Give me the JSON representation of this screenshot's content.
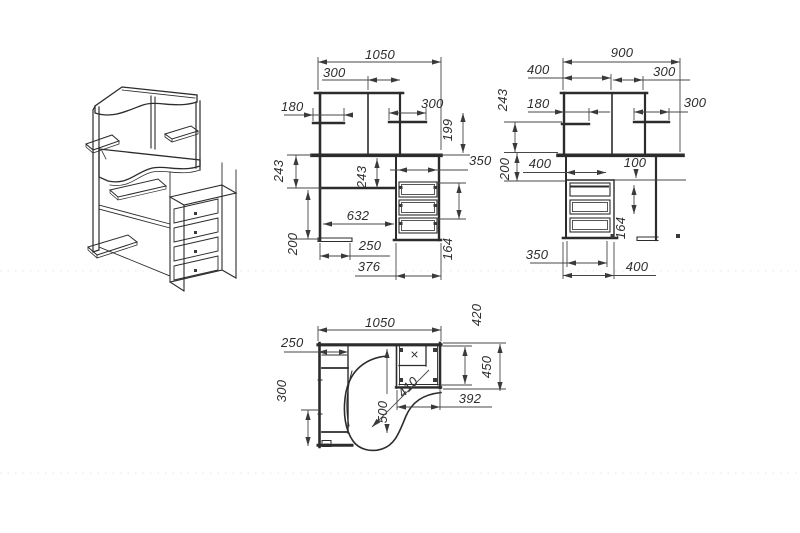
{
  "drawing": {
    "kind": "corner-computer-desk-blueprint",
    "front": {
      "overall_width": "1050",
      "hutch_bay_width": "300",
      "left_shelf_width": "180",
      "right_shelf_width": "300",
      "shelf_to_desktop": "199",
      "pedestal_inner_width": "350",
      "desktop_to_shelf_left": "243",
      "desktop_to_shelf_mid": "243",
      "kneehole_width": "632",
      "shelf_to_floor": "200",
      "foot_width": "250",
      "pedestal_outer_width": "376",
      "drawer_pitch": "164"
    },
    "side": {
      "overall_depth": "900",
      "hutch_left_bay": "400",
      "hutch_right_bay": "300",
      "shelf_to_desktop": "243",
      "shelf_depth": "180",
      "outer_shelf_depth": "300",
      "desktop_to_pedestal": "200",
      "pedestal_top_depth": "400",
      "drawer_inset": "100",
      "drawer_pitch": "164",
      "pedestal_inner_depth": "350",
      "pedestal_outer_depth": "400"
    },
    "plan": {
      "overall_width": "1050",
      "return_inner_depth": "420",
      "left_end_width": "250",
      "return_outer_depth": "450",
      "left_front_depth": "300",
      "corner_depth": "500",
      "corner_diagonal": "410",
      "return_width": "392"
    }
  }
}
